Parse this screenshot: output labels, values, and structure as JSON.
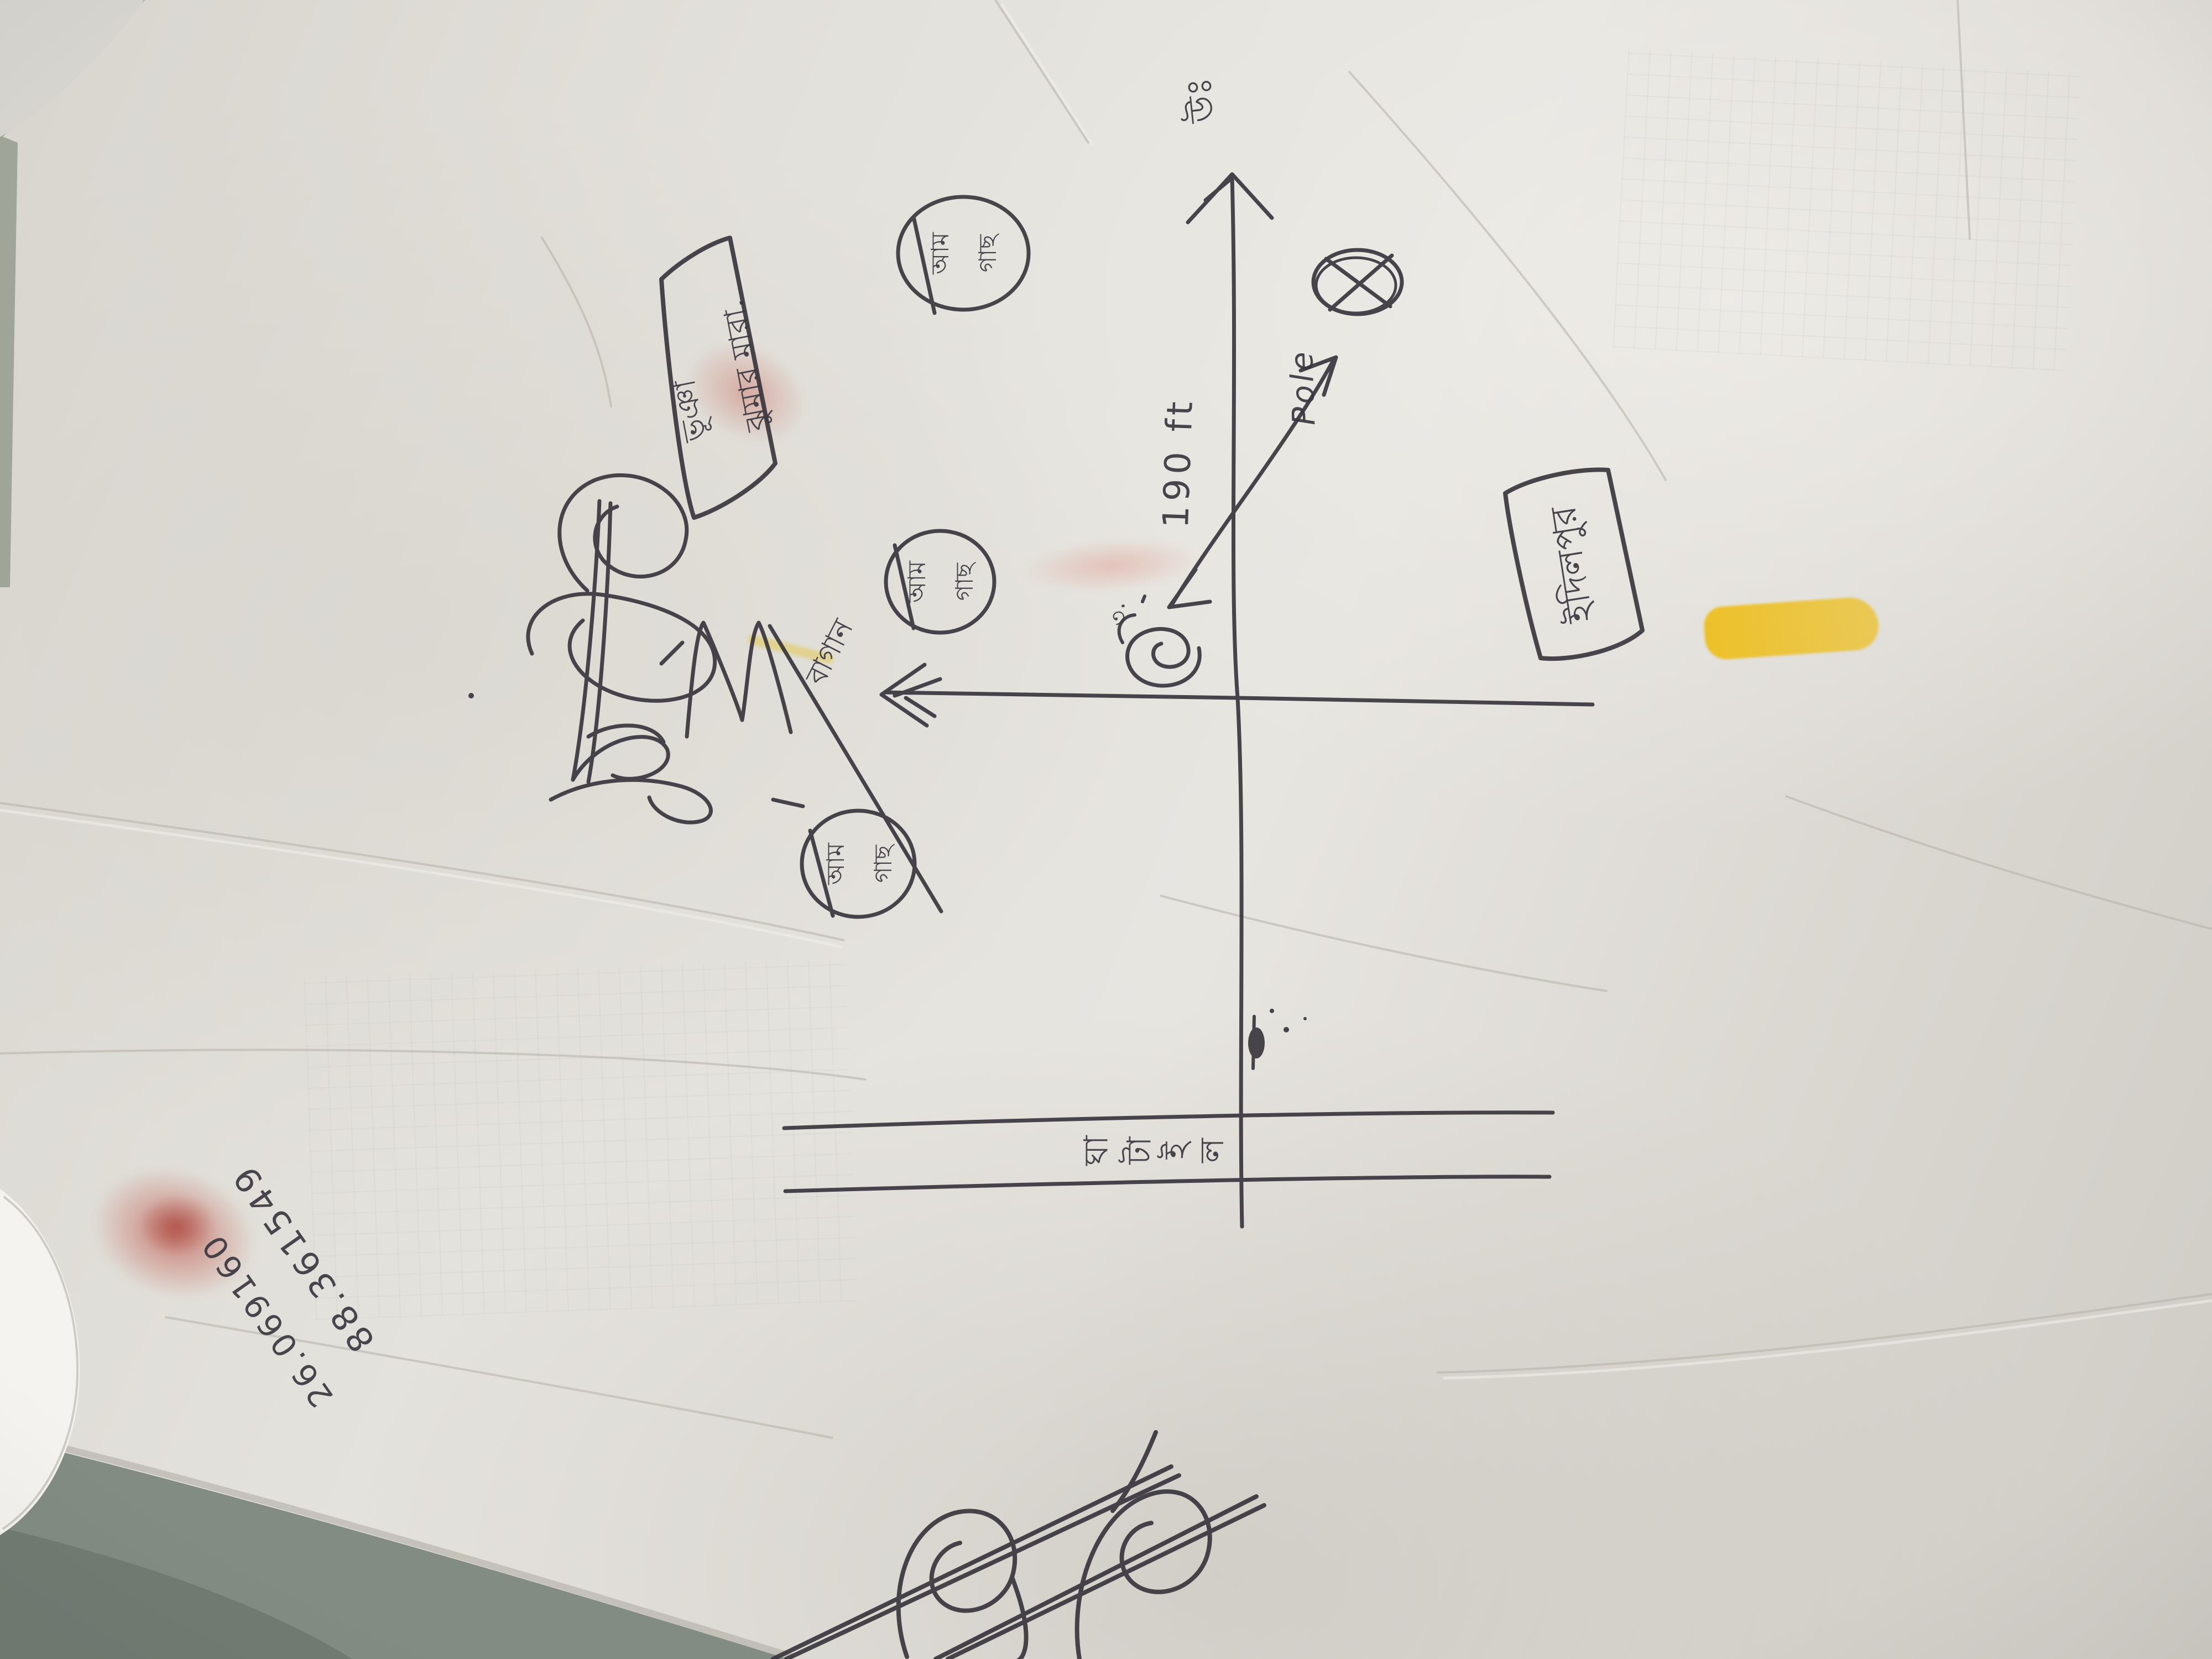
{
  "photo": {
    "kind": "photograph of a hand-drawn land sketch map on crumpled paper",
    "orientation_note": "all handwriting is rotated ~90° counter-clockwise in the photo"
  },
  "colors": {
    "background": "#828c82",
    "paper": "#e3e1db",
    "ink": "#35323a",
    "highlighter_yellow": "#eebc10",
    "smudge_red": "#b42d20"
  },
  "map": {
    "north_label": "উঃ",
    "pole": {
      "label": "Pole",
      "marker": "X"
    },
    "dimension": {
      "label": "190 ft"
    },
    "corner_mark": "৩.",
    "boxes": [
      {
        "lines": [
          "ঝুমার মারা.",
          "ভূঞা"
        ]
      },
      {
        "lines": [
          "ইদিলপুর"
        ]
      }
    ],
    "trees": [
      {
        "lines": [
          "আম",
          "গাছ"
        ]
      },
      {
        "lines": [
          "আম",
          "গাছ"
        ]
      },
      {
        "lines": [
          "আম",
          "গাছ"
        ]
      }
    ],
    "path_label": "বাগান",
    "road_label": "ঘাটাইল",
    "road_label_clusters": [
      "ঘা",
      "টা",
      "ই",
      "ল"
    ],
    "numbers": [
      "88.361549",
      "26.069160"
    ]
  }
}
